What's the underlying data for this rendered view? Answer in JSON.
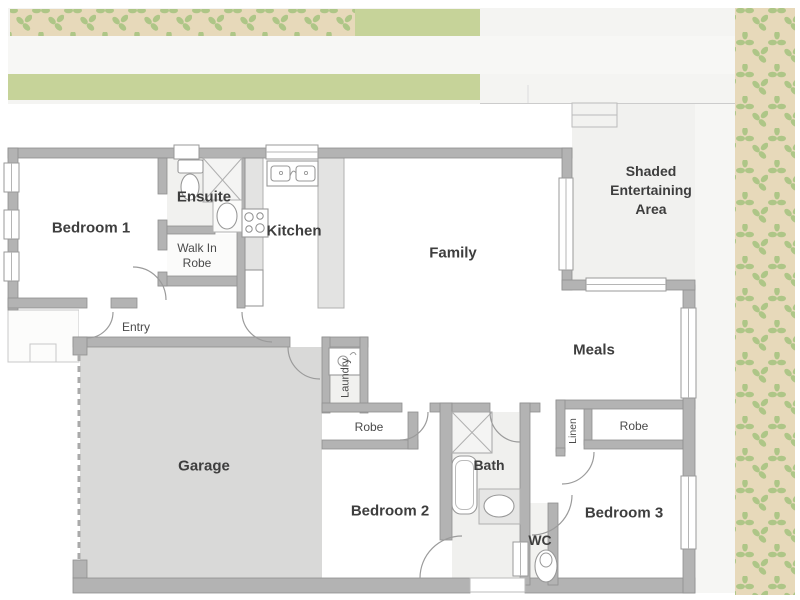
{
  "plan": {
    "rooms": {
      "bedroom1": "Bedroom 1",
      "ensuite": "Ensuite",
      "walk_in_robe_line1": "Walk In",
      "walk_in_robe_line2": "Robe",
      "kitchen": "Kitchen",
      "family": "Family",
      "shaded_line1": "Shaded",
      "shaded_line2": "Entertaining",
      "shaded_line3": "Area",
      "meals": "Meals",
      "entry": "Entry",
      "garage": "Garage",
      "laundry": "Laundry",
      "robe_bed2": "Robe",
      "bedroom2": "Bedroom 2",
      "bath": "Bath",
      "wc": "WC",
      "linen": "Linen",
      "robe_bed3": "Robe",
      "bedroom3": "Bedroom 3"
    },
    "colors": {
      "wall": "#b3b3b3",
      "garage_floor": "#d9d9d8",
      "wet_area_floor": "#f1f1ef",
      "garden_bed": "#e7d9ba",
      "foliage": "#aec687",
      "lawn": "#c6d399",
      "paving": "#f4f4f2",
      "shaded_paving": "#f1f1ef",
      "label_bold": "#3e3e3e",
      "label_regular": "#4a4a4a"
    }
  }
}
